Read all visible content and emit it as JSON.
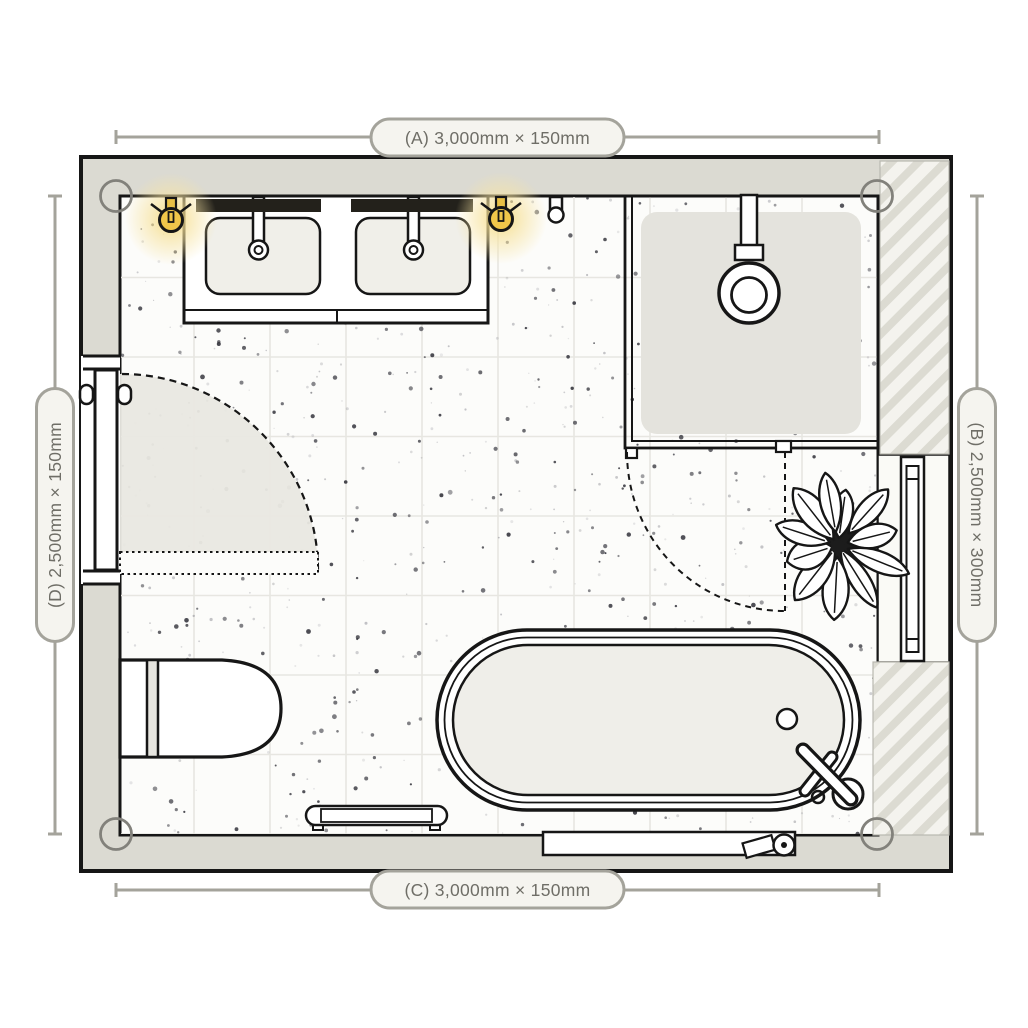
{
  "title": "Bathroom floor plan",
  "dimensions": {
    "top": {
      "id": "A",
      "label": "(A) 3,000mm × 150mm"
    },
    "right": {
      "id": "B",
      "label": "(B) 2,500mm × 300mm"
    },
    "bottom": {
      "id": "C",
      "label": "(C) 3,000mm × 150mm"
    },
    "left": {
      "id": "D",
      "label": "(D) 2,500mm × 150mm"
    }
  },
  "fixtures": [
    "double-vanity",
    "sink-left",
    "sink-right",
    "mirror-left",
    "mirror-right",
    "wall-light-left",
    "wall-light-right",
    "robe-hook",
    "shower-enclosure",
    "shower-head",
    "shower-door-swing",
    "entry-door",
    "door-swing",
    "toilet",
    "bathtub",
    "bath-faucet",
    "bath-drain",
    "towel-rail",
    "wall-niche",
    "towel-radiator",
    "potted-plant",
    "corner-markers"
  ],
  "colors": {
    "wall": "#dbdad2",
    "floor": "#fcfcfa",
    "line": "#161616",
    "hatch_stripe": "#dcdbd2",
    "hatch_bg": "#f4f3ee",
    "tray": "#e4e3dd",
    "basin": "#f0efe9",
    "swing": "#e9e8e2",
    "accent_light": "#f0c64a",
    "glow": "#f7de8f",
    "dim_line": "#a4a39b",
    "pill_bg": "#f5f4ef",
    "pill_text": "#6f6e67"
  }
}
